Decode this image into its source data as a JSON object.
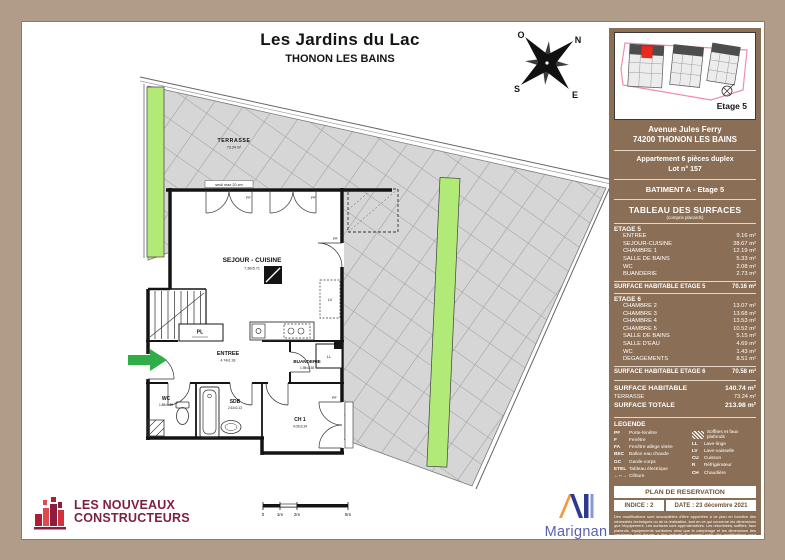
{
  "title": {
    "line1": "Les Jardins du Lac",
    "line2": "THONON LES BAINS"
  },
  "compass": {
    "n": "N",
    "e": "E",
    "s": "S",
    "o": "O"
  },
  "plan": {
    "terrasse_label": "TERRASSE",
    "terrasse_dim": "73.24 m²",
    "seuil": "seuil max 20 cm",
    "sejour_label": "SEJOUR - CUISINE",
    "sejour_dim": "7.36x5.71",
    "pl": "PL",
    "entree_label": "ENTREE",
    "entree_dim": "4.74x1.93",
    "buanderie_label": "BUANDERIE",
    "buanderie_dim": "1.98x1.38",
    "wc_label": "WC",
    "wc_dim": "1.88x1.30",
    "sdb_label": "SDB",
    "sdb_dim": "2.61x2.13",
    "ch1_label": "CH 1",
    "ch1_dim": "4.03x3.34",
    "pf": "PF",
    "ll": "LL",
    "lv": "LV",
    "scale": [
      "0",
      "1m",
      "2m",
      "5m"
    ]
  },
  "sidebar": {
    "minimap_etage": "Etage 5",
    "address1": "Avenue Jules Ferry",
    "address2": "74200 THONON LES BAINS",
    "apt1": "Appartement 6 pièces duplex",
    "apt2": "Lot n° 157",
    "batiment": "BATIMENT  A - Etage 5",
    "table_title": "TABLEAU DES SURFACES",
    "table_subtitle": "(compris placards)",
    "etage5": {
      "header": "ETAGE 5",
      "rows": [
        {
          "label": "ENTREE",
          "value": "9.16 m²"
        },
        {
          "label": "SEJOUR-CUISINE",
          "value": "38.67 m²"
        },
        {
          "label": "CHAMBRE 1",
          "value": "12.19 m²"
        },
        {
          "label": "SALLE DE BAINS",
          "value": "5.33 m²"
        },
        {
          "label": "WC",
          "value": "2.08 m²"
        },
        {
          "label": "BUANDERIE",
          "value": "2.73 m²"
        }
      ],
      "total_label": "SURFACE HABITABLE ETAGE 5",
      "total_value": "70.16 m²"
    },
    "etage6": {
      "header": "ETAGE 6",
      "rows": [
        {
          "label": "CHAMBRE 2",
          "value": "13.07 m²"
        },
        {
          "label": "CHAMBRE 3",
          "value": "13.68 m²"
        },
        {
          "label": "CHAMBRE 4",
          "value": "13.53 m²"
        },
        {
          "label": "CHAMBRE 5",
          "value": "10.52 m²"
        },
        {
          "label": "SALLE DE BAINS",
          "value": "5.15 m²"
        },
        {
          "label": "SALLE D'EAU",
          "value": "4.69 m²"
        },
        {
          "label": "WC",
          "value": "1.43 m²"
        },
        {
          "label": "DEGAGEMENTS",
          "value": "8.51 m²"
        }
      ],
      "total_label": "SURFACE HABITABLE ETAGE 6",
      "total_value": "70.58 m²"
    },
    "totals": {
      "habitable_label": "SURFACE HABITABLE",
      "habitable_value": "140.74 m²",
      "terrasse_label": "TERRASSE",
      "terrasse_value": "73.24 m²",
      "totale_label": "SURFACE TOTALE",
      "totale_value": "213.98 m²"
    },
    "legend": {
      "title": "LEGENDE",
      "left": [
        {
          "abbr": "PF",
          "label": "Porte-fenêtre"
        },
        {
          "abbr": "F",
          "label": "Fenêtre"
        },
        {
          "abbr": "FA",
          "label": "Fenêtre allège vitrée"
        },
        {
          "abbr": "BEC",
          "label": "Ballon eau chaude"
        },
        {
          "abbr": "GC",
          "label": "Garde-corps"
        },
        {
          "abbr": "ETEL",
          "label": "Tableau électrique"
        },
        {
          "abbr": "←--→",
          "label": "Clôture"
        }
      ],
      "soffites_label": "Soffites et faux plafonds",
      "right": [
        {
          "abbr": "LL",
          "label": "Lave-linge"
        },
        {
          "abbr": "LV",
          "label": "Lave-vaisselle"
        },
        {
          "abbr": "CU",
          "label": "Cuisson"
        },
        {
          "abbr": "R",
          "label": "Réfrigérateur"
        },
        {
          "abbr": "CH",
          "label": "Chaudière"
        }
      ]
    },
    "reservation": "PLAN DE RESERVATION",
    "indice": "INDICE : 2",
    "date": "DATE : 23 décembre 2021",
    "fineprint": "Des modifications sont susceptibles d'être apportées à ce plan en fonction des nécessités techniques ou de la réalisation, tant en ce qui concerne les dimensions que l'équipement. Les surfaces sont approximatives. Les retombées, soffites, faux plafonds, équipements sanitaires ainsi que le calepinage et les dimensions des carrelages sont figurés à titre indicatif et peuvent subir des modifications pour impératifs techniques. Les appareils ménagers ne sont pas fournis. Les coffres de volets roulants ne sont pas représentés et peuvent être apparents à l'intérieur. La hauteur sous retombées et faux plafonds peut varier de 5 à 30 cm à partir du sol intérieur. La hauteur entre le jardin et la terrasse pourra varier entre 0 et 60 cm. Les jardins ne seront pas nécessairement plats et pourront comporter des talus et des pentes."
  },
  "footer": {
    "lnc1": "LES NOUVEAUX",
    "lnc2": "CONSTRUCTEURS",
    "marignan": "Marignan"
  }
}
